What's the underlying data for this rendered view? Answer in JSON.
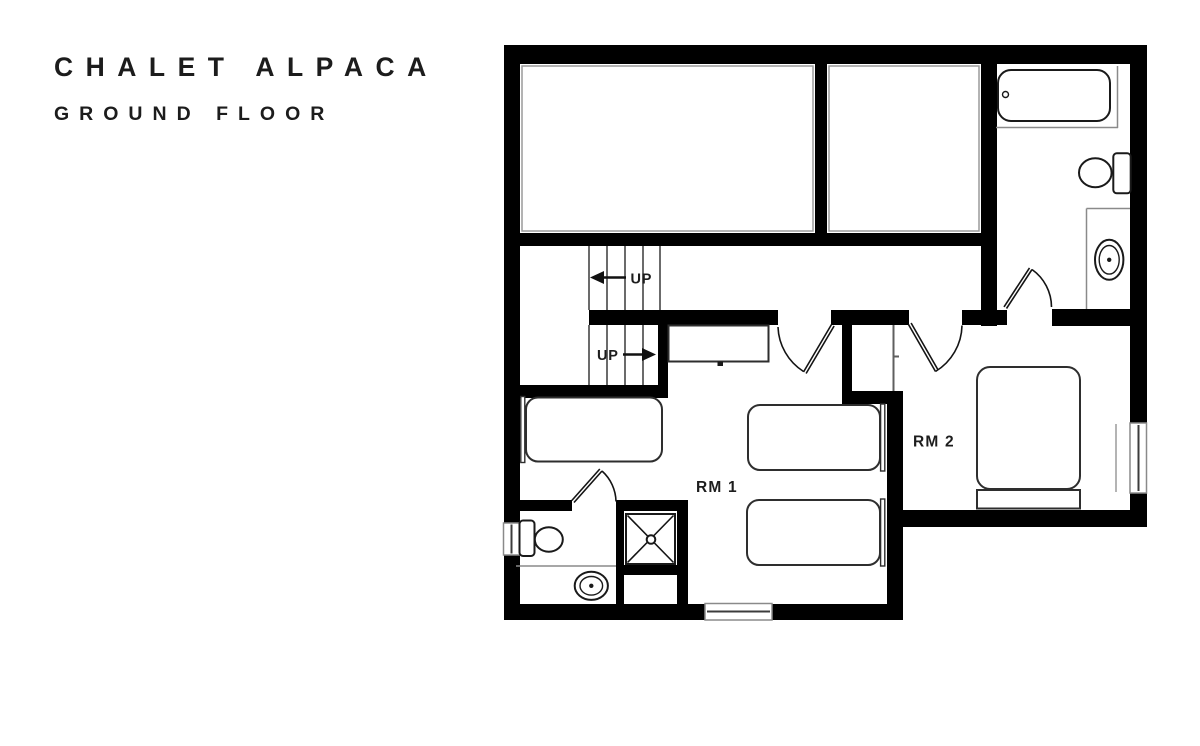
{
  "header": {
    "title": "CHALET ALPACA",
    "subtitle": "GROUND FLOOR"
  },
  "plan": {
    "room1": {
      "label": "RM 1",
      "beds": 3
    },
    "room2": {
      "label": "RM 2",
      "beds": 1
    },
    "stairs": {
      "upper_up_label": "UP",
      "lower_up_label": "UP"
    },
    "fixtures": {
      "top_bathroom": [
        "bathtub",
        "toilet",
        "sink-vanity"
      ],
      "ensuite_bathroom": [
        "toilet",
        "sink-vanity",
        "shower"
      ],
      "room1_furniture": [
        "single-bed",
        "single-bed",
        "single-bed",
        "console"
      ],
      "room2_furniture": [
        "double-bed",
        "wardrobe"
      ]
    },
    "window_count": 3,
    "door_count": 4,
    "colors": {
      "walls": "#000000",
      "thin_lines": "#8a8a8a",
      "fixture_outline": "#1a1a1a",
      "text": "#1d1d1d",
      "background": "#ffffff"
    }
  }
}
